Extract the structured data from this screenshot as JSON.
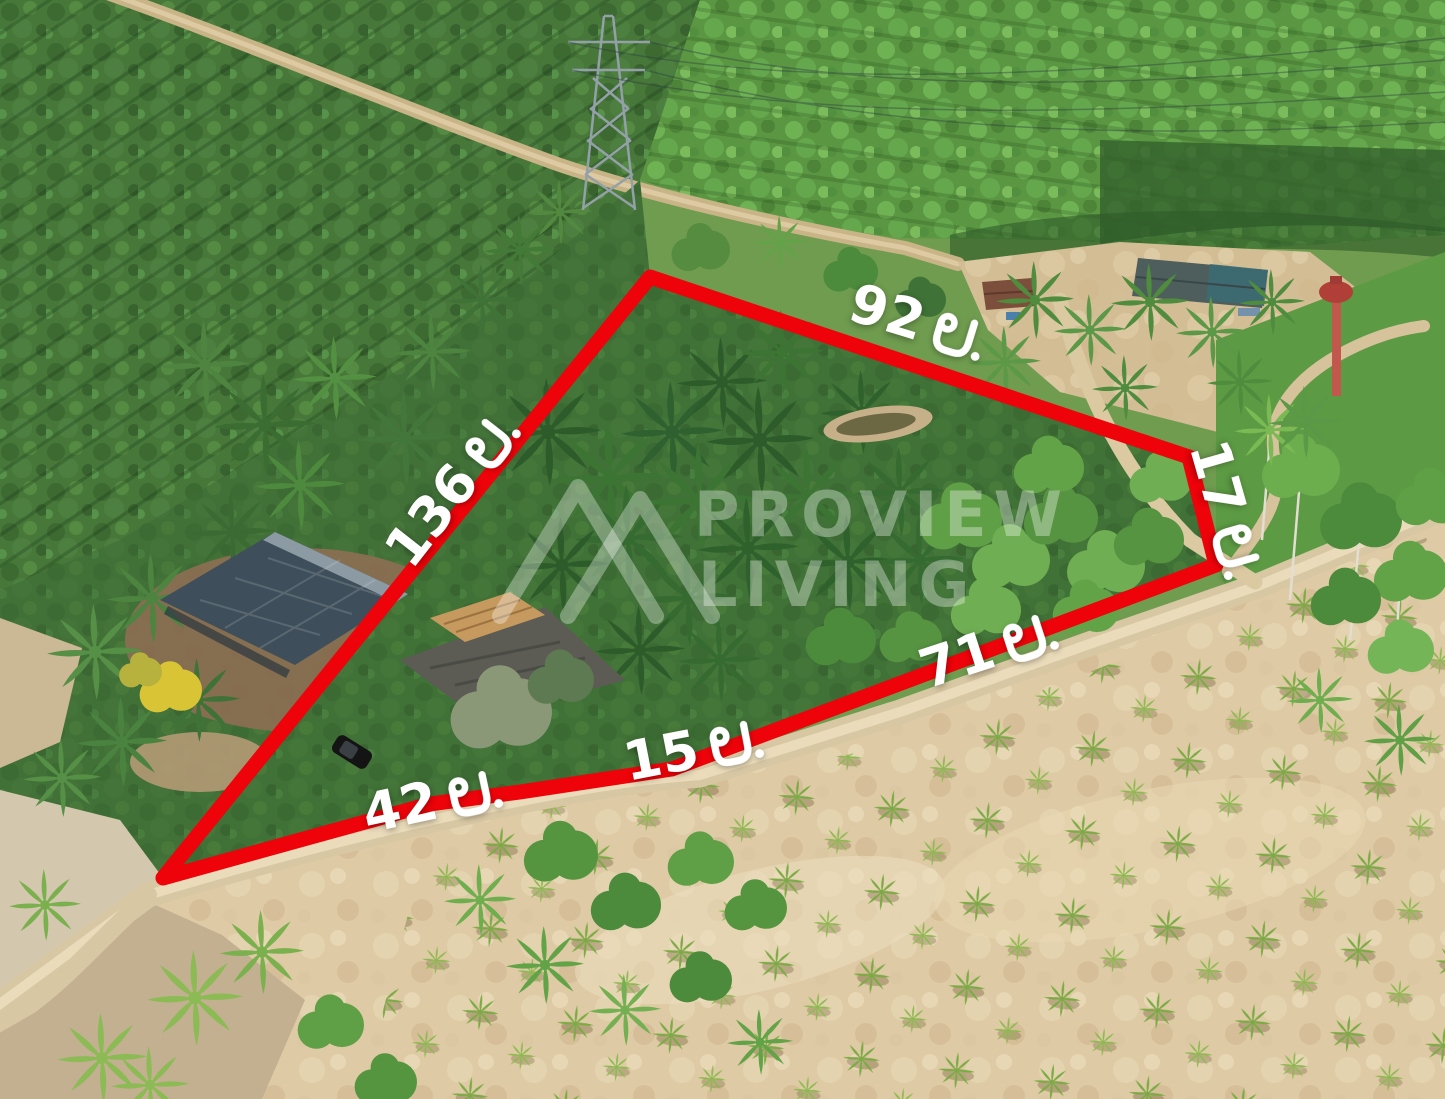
{
  "photo": {
    "description": "Aerial drone photo of a land plot outlined in red, surrounded by rubber plantation, coconut grove, farm buildings, a dirt road and a dry field",
    "boundary_color": "#ed0309",
    "label_text_color": "#ffffff",
    "watermark_color": "rgba(255,255,255,0.34)"
  },
  "watermark": {
    "line1": "PROVIEW",
    "line2": "LIVING"
  },
  "measurements": [
    {
      "side": "top-edge",
      "value": "92",
      "unit": "ม.",
      "label": "92 ม."
    },
    {
      "side": "upper-right-edge",
      "value": "17",
      "unit": "ม.",
      "label": "17 ม."
    },
    {
      "side": "lower-right-edge",
      "value": "71",
      "unit": "ม.",
      "label": "71 ม."
    },
    {
      "side": "bottom-middle-edge",
      "value": "15",
      "unit": "ม.",
      "label": "15 ม."
    },
    {
      "side": "bottom-left-edge",
      "value": "42",
      "unit": "ม.",
      "label": "42 ม."
    },
    {
      "side": "left-diagonal-edge",
      "value": "136",
      "unit": "ม.",
      "label": "136 ม."
    }
  ],
  "landmarks": [
    "rubber-plantation",
    "transmission-pylon",
    "power-lines",
    "farmstead-houses",
    "water-tank-tower",
    "coconut-grove",
    "pavilion-building",
    "warehouse-building",
    "black-car",
    "pond",
    "oil-palm-plot",
    "dirt-road",
    "dry-field-with-young-palms"
  ]
}
